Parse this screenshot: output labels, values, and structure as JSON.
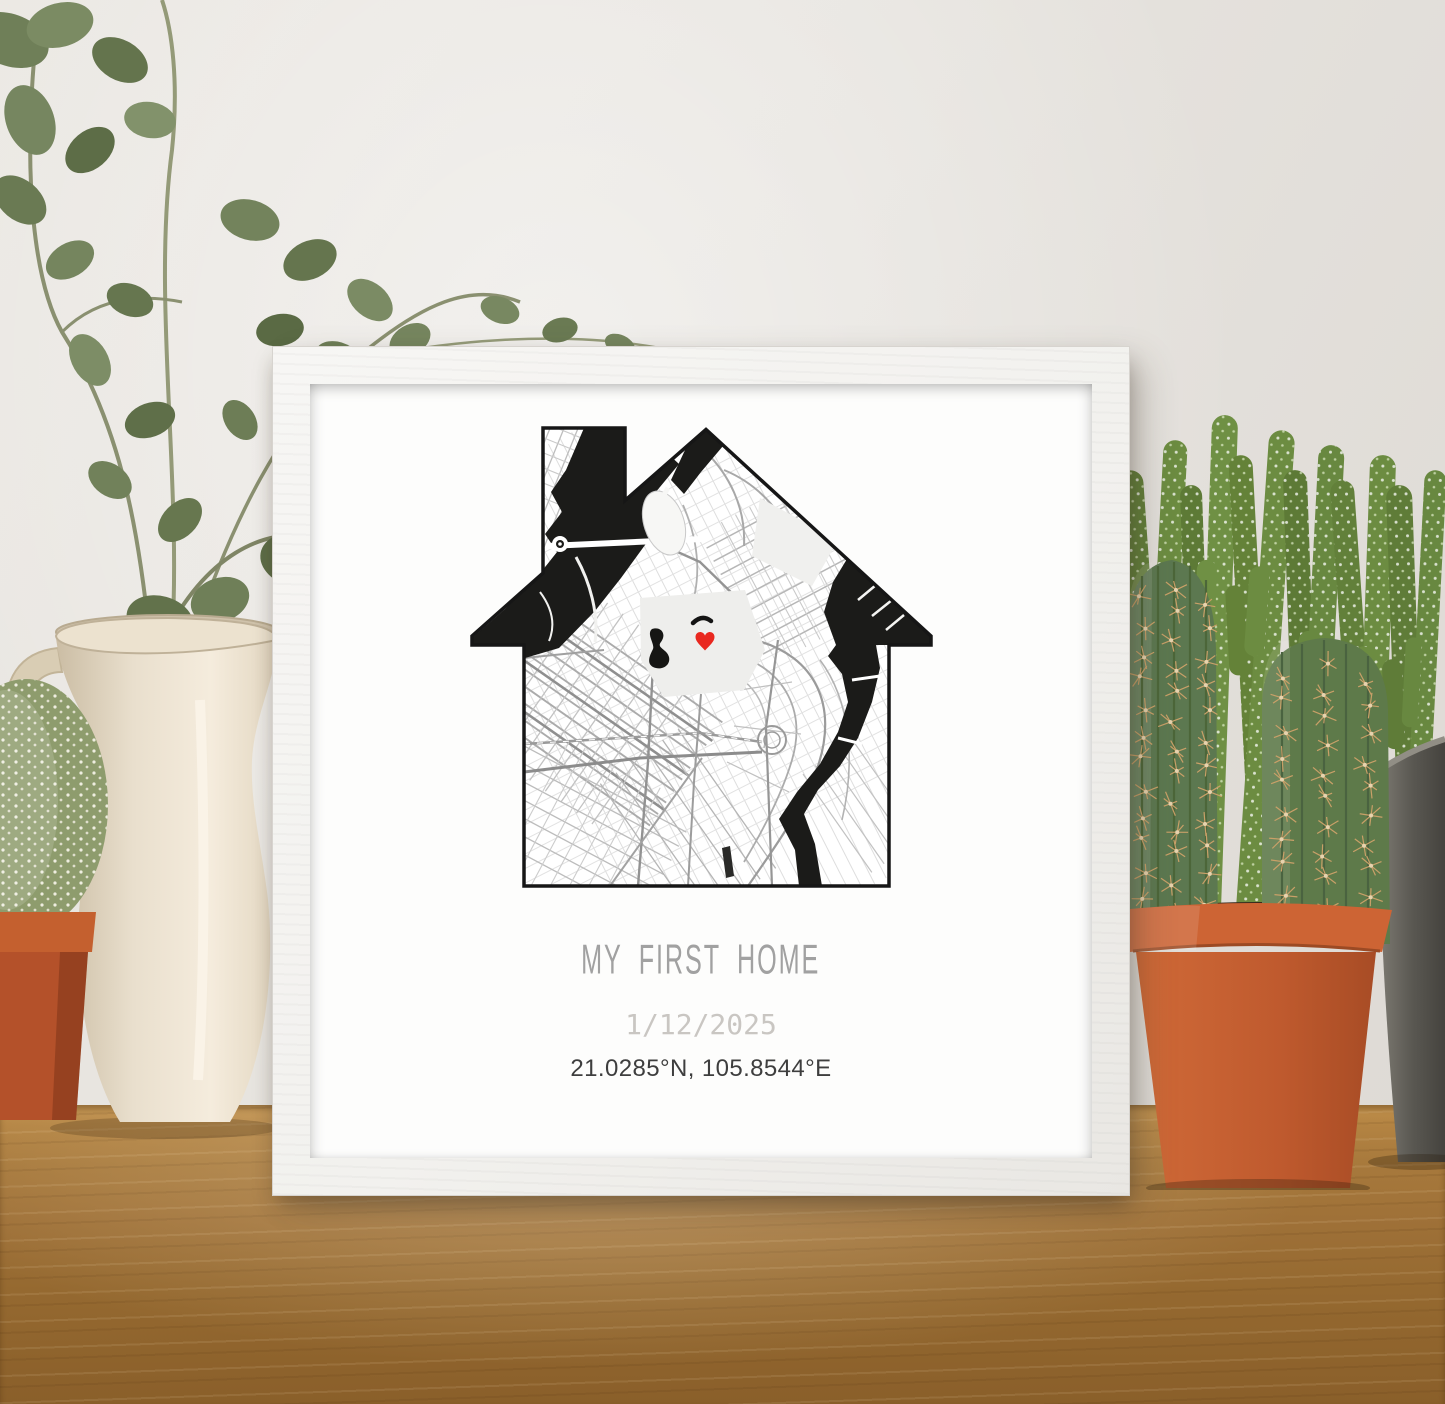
{
  "scene": {
    "wall_color": "#e6e3de",
    "table_wood_color": "#a7793c"
  },
  "frame": {
    "color": "#f2f1ee",
    "paper_color": "#fdfdfc"
  },
  "print": {
    "title": "MY FIRST HOME",
    "date": "1/12/2025",
    "coordinates": "21.0285°N, 105.8544°E",
    "title_color": "#a1a1a1",
    "date_color": "#c9c6c2",
    "coordinates_color": "#3e3e3e",
    "map": {
      "shape": "house-with-chimney",
      "water_color": "#1b1b19",
      "road_color": "#9c9c9c",
      "marker_icon": "heart-marker-icon",
      "marker_color": "#e9281f"
    }
  },
  "decor": {
    "left_plant": "eucalyptus-in-pitcher",
    "left_small_plant": "ball-cactus-in-terracotta-pot",
    "right_front_plant": "columnar-cacti-in-terracotta-pot",
    "right_back_plant": "knobby-cacti-in-metal-bucket",
    "terracotta_color": "#c05a2e",
    "cactus_green": "#62803a",
    "metal_pot_color": "#5a5852",
    "pitcher_color": "#e9dfcd"
  }
}
